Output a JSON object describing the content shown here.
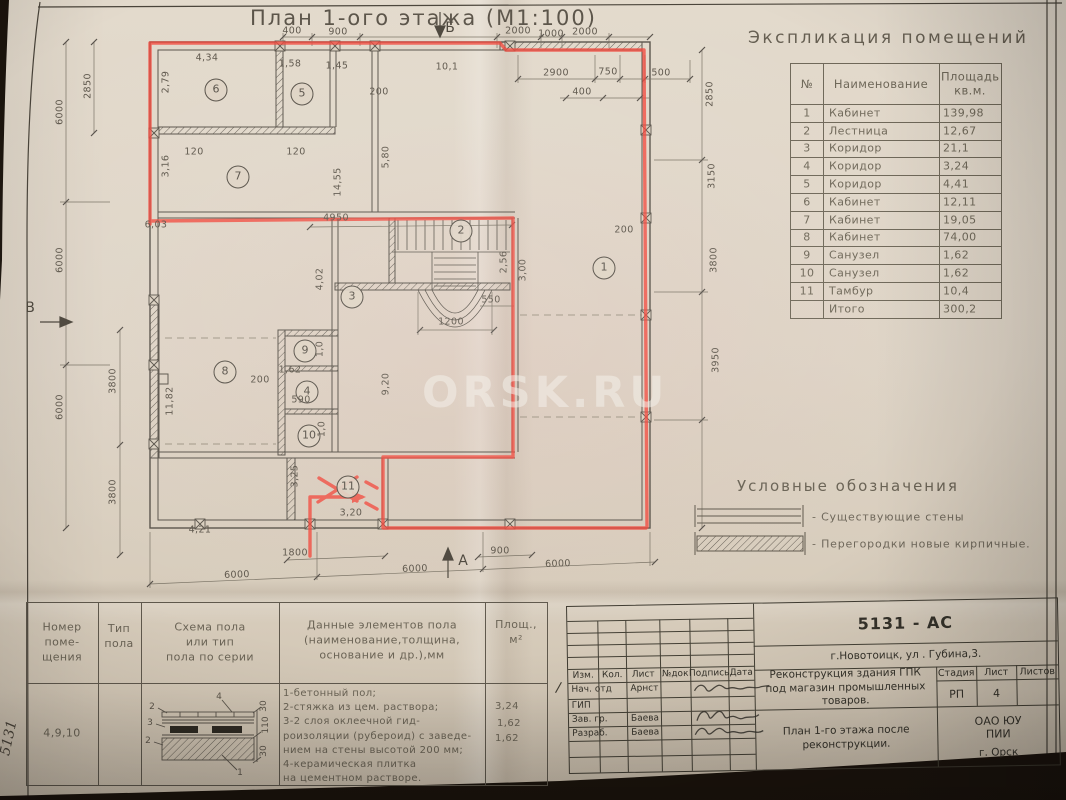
{
  "colors": {
    "photo_background": "#241a11",
    "paper": "#ddd3c3",
    "ink": "#59534a",
    "red_marker": "#f2473b"
  },
  "photo": {
    "watermark": "ORSK.RU",
    "side_code": "5131"
  },
  "plan": {
    "title": "План 1-ого этажа (М1:100)",
    "axes": {
      "top": "Б",
      "left": "В",
      "bottom": "А"
    },
    "rooms": [
      "1",
      "2",
      "3",
      "4",
      "5",
      "6",
      "7",
      "8",
      "9",
      "10",
      "11"
    ],
    "dims": [
      "400",
      "900",
      "2000",
      "1000",
      "2000",
      "2900",
      "750",
      "500",
      "400",
      "10,1",
      "6000",
      "6000",
      "6000",
      "2850",
      "3800",
      "3800",
      "2850",
      "3150",
      "3800",
      "3950",
      "4,34",
      "2,79",
      "1,58",
      "1,45",
      "3,16",
      "120",
      "120",
      "5,80",
      "14,55",
      "200",
      "6,03",
      "4950",
      "200",
      "2,56",
      "3,00",
      "550",
      "1200",
      "4,02",
      "9,20",
      "200",
      "1,62",
      "1,0",
      "590",
      "1,0",
      "11,82",
      "4,21",
      "3,25",
      "3,20",
      "1800",
      "900",
      "6000",
      "6000",
      "6000"
    ]
  },
  "explication": {
    "title": "Экспликация помещений",
    "columns": [
      "№",
      "Наименование",
      "Площадь кв.м."
    ],
    "rows": [
      [
        "1",
        "Кабинет",
        "139,98"
      ],
      [
        "2",
        "Лестница",
        "12,67"
      ],
      [
        "3",
        "Коридор",
        "21,1"
      ],
      [
        "4",
        "Коридор",
        "3,24"
      ],
      [
        "5",
        "Коридор",
        "4,41"
      ],
      [
        "6",
        "Кабинет",
        "12,11"
      ],
      [
        "7",
        "Кабинет",
        "19,05"
      ],
      [
        "8",
        "Кабинет",
        "74,00"
      ],
      [
        "9",
        "Санузел",
        "1,62"
      ],
      [
        "10",
        "Санузел",
        "1,62"
      ],
      [
        "11",
        "Тамбур",
        "10,4"
      ],
      [
        "",
        "Итого",
        "300,2"
      ]
    ]
  },
  "legend": {
    "title": "Условные обозначения",
    "items": [
      {
        "symbol": "existing-wall",
        "label": "- Существующие стены"
      },
      {
        "symbol": "new-brick-partition",
        "label": "- Перегородки новые кирпичные."
      }
    ]
  },
  "floor_table": {
    "headers": {
      "room": "Номер\nпоме-\nщения",
      "type": "Тип\nпола",
      "schema": "Схема пола\nили тип\nпола по серии",
      "data": "Данные элементов пола\n(наименование,толщина,\nоснование и др.),мм",
      "area": "Площ.,\nм²"
    },
    "row": {
      "room_numbers": "4,9,10",
      "data_text": "1-бетонный пол;\n2-стяжка из цем. раствора;\n3-2 слоя оклеечной гид-\nроизоляции (рубероид) с заведе-\nнием на стены высотой 200 мм;\n4-керамическая плитка\nна цементном растворе.",
      "areas": [
        "3,24",
        "1,62",
        "1,62"
      ],
      "callouts": [
        "4",
        "2",
        "3",
        "2",
        "1",
        "30",
        "110",
        "30"
      ]
    }
  },
  "title_block": {
    "code": "5131 - АС",
    "address": "г.Новотоицк, ул . Губина,3.",
    "project": "Реконструкция здания ГПК под магазин промышленных товаров.",
    "doc_title": "План 1-го этажа  после реконструкции.",
    "stage_label": "Стадия",
    "sheet_label": "Лист",
    "sheets_label": "Листов",
    "stage": "РП",
    "sheet_num": "4",
    "org": "ОАО ЮУ  ПИИ",
    "city": "г. Орск",
    "margin_mark": "/",
    "cols": [
      "Изм.",
      "Кол.",
      "Лист",
      "№док",
      "Подпись",
      "Дата"
    ],
    "rows": [
      {
        "role": "Нач. отд",
        "name": "Арнст"
      },
      {
        "role": "ГИП",
        "name": ""
      },
      {
        "role": "Зав. гр.",
        "name": "Баева"
      },
      {
        "role": "Разраб.",
        "name": "Баева"
      }
    ]
  }
}
